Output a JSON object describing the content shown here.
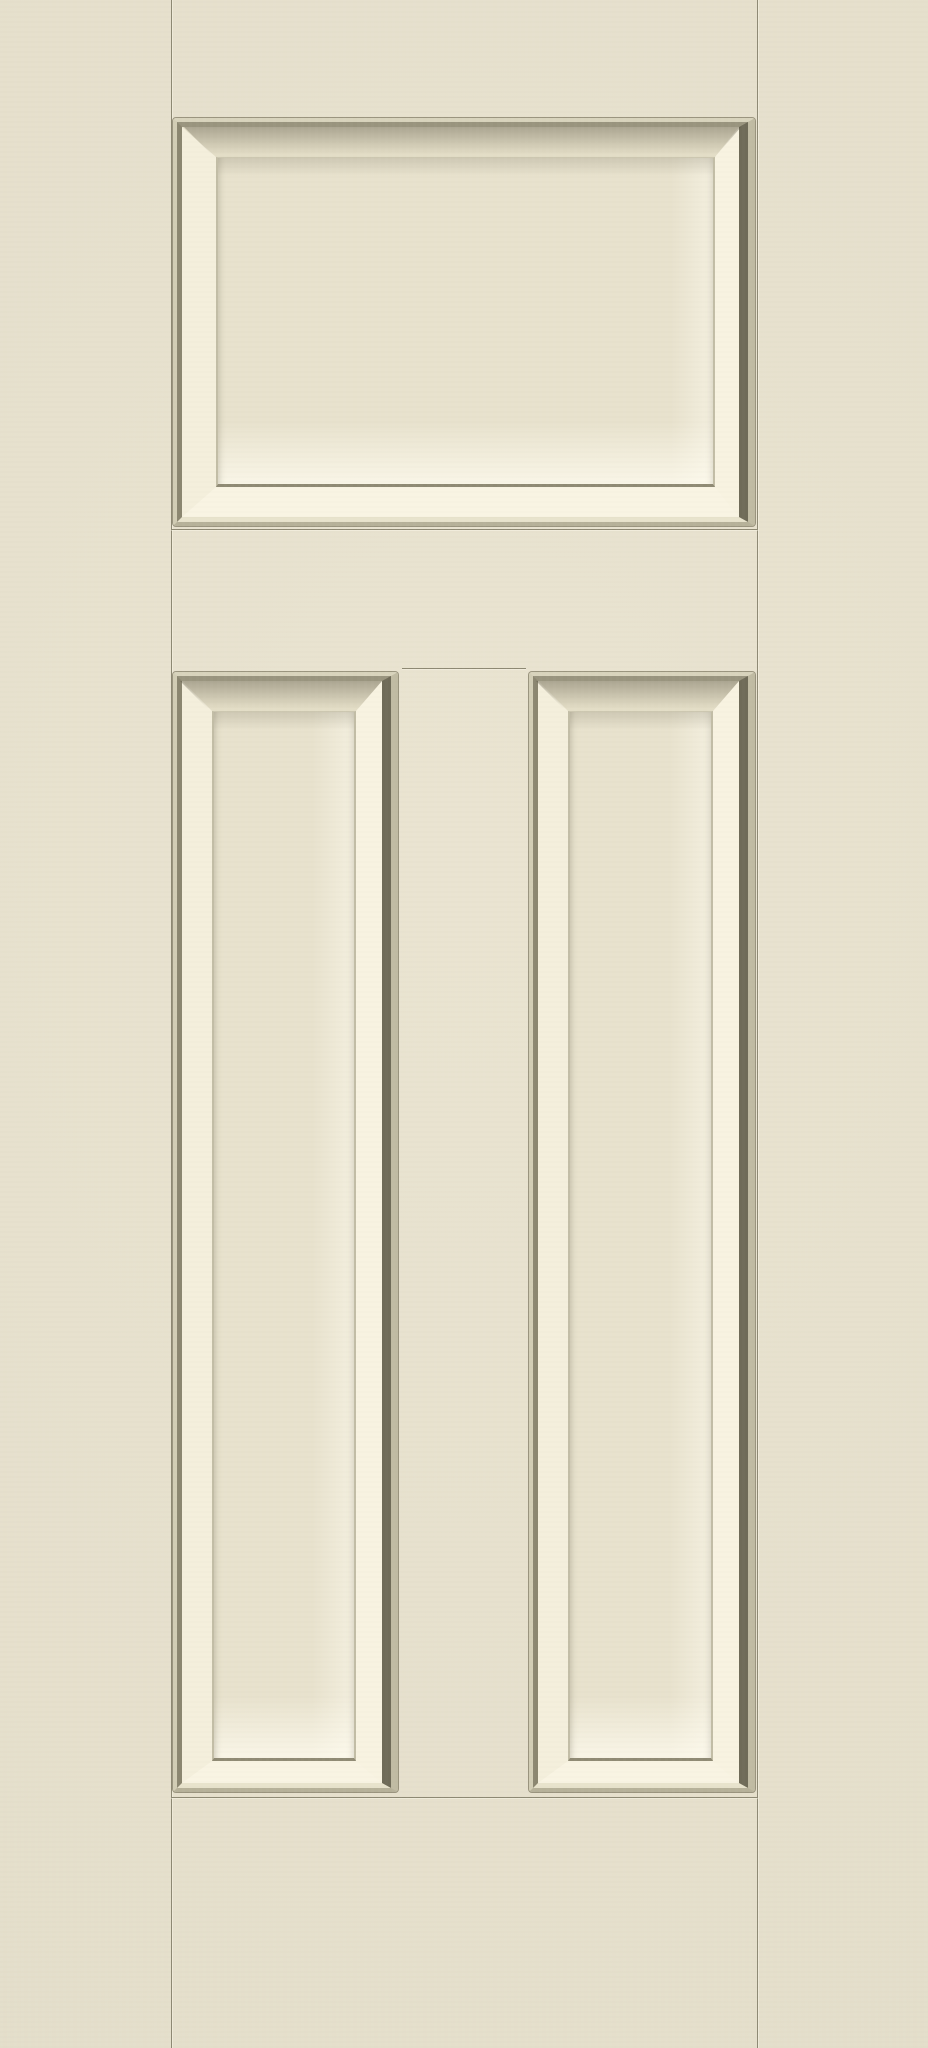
{
  "image": {
    "kind": "product-photo",
    "subject": "Smooth almond-cream painted 3-panel craftsman exterior door slab, straight-on view",
    "width_px": 928,
    "height_px": 2048
  },
  "door": {
    "style": "craftsman-3-panel",
    "finish": "smooth painted cream / almond",
    "colors": {
      "face": "#e9e3cf",
      "field": "#e8e2cd",
      "seam": "#8d8873",
      "seam_highlight": "rgba(255,252,240,0.38)",
      "panel_outline": "rgba(145,140,118,0.9)",
      "molding_outer_top": "#d8d3bc",
      "molding_outer_right": "#c0bba3",
      "molding_outer_bottom": "#b6b199",
      "molding_outer_left": "#d2cdb5",
      "molding_inner_top": "#99947e",
      "molding_inner_right": "#6f6b58",
      "molding_inner_bottom": "#e8e3cc",
      "molding_inner_left": "#8b8670",
      "bevel_top": "#e3ddc6",
      "bevel_right": "#f8f3e1",
      "bevel_bottom": "#f9f4e3",
      "bevel_left": "#f4efdc",
      "field_line_top": "#cdc8b1",
      "field_line_side": "#c2bda6",
      "field_shadow_line": "#8f8a74"
    },
    "panels": [
      {
        "id": "top",
        "label": "top horizontal raised panel",
        "x": 173,
        "y": 118,
        "w": 582,
        "h": 408
      },
      {
        "id": "left",
        "label": "lower-left vertical raised panel",
        "x": 173,
        "y": 672,
        "w": 225,
        "h": 1120
      },
      {
        "id": "right",
        "label": "lower-right vertical raised panel",
        "x": 529,
        "y": 672,
        "w": 226,
        "h": 1120
      }
    ],
    "seams": [
      {
        "id": "stile-left",
        "orient": "v",
        "x": 171,
        "y": 0,
        "len": 2048
      },
      {
        "id": "stile-right",
        "orient": "v",
        "x": 757,
        "y": 0,
        "len": 2048
      },
      {
        "id": "rail-mid",
        "orient": "h",
        "x": 171,
        "y": 529,
        "len": 587
      },
      {
        "id": "center-stile-top",
        "orient": "h",
        "x": 402,
        "y": 668,
        "len": 124
      },
      {
        "id": "rail-bottom",
        "orient": "h",
        "x": 171,
        "y": 1797,
        "len": 587
      }
    ]
  }
}
